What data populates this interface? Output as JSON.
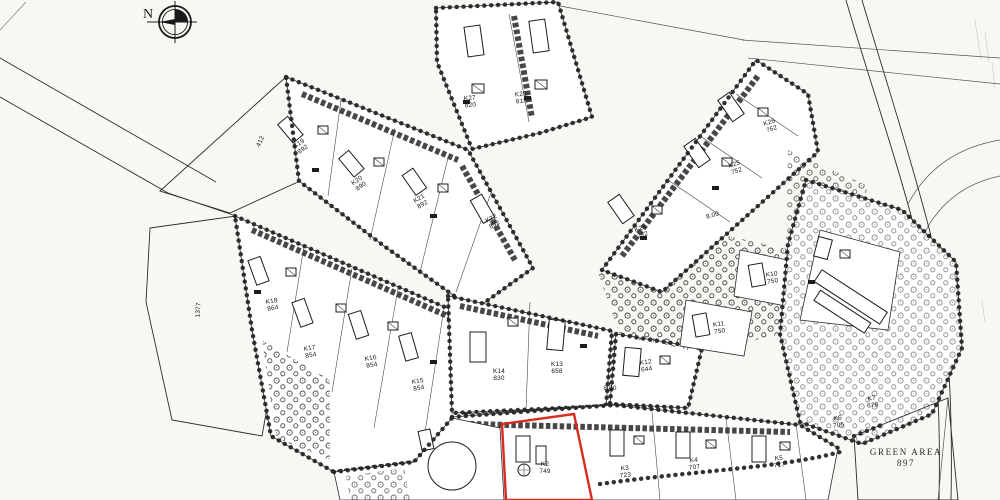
{
  "map": {
    "compass_label": "N",
    "green_area": {
      "name": "GREEN AREA",
      "number": "897"
    },
    "open_parcels": [
      {
        "number": "412"
      },
      {
        "number": "1377"
      }
    ],
    "dimensions": [
      "8.00",
      "8.00"
    ],
    "plots": [
      {
        "code": "K27",
        "area": "820"
      },
      {
        "code": "K28",
        "area": "818"
      },
      {
        "code": "K19",
        "area": "892"
      },
      {
        "code": "K20",
        "area": "890"
      },
      {
        "code": "K21",
        "area": "892"
      },
      {
        "code": "K22",
        "area": "832"
      },
      {
        "code": "K24",
        "area": "732"
      },
      {
        "code": "K25",
        "area": "752"
      },
      {
        "code": "K26",
        "area": "762"
      },
      {
        "code": "K18",
        "area": "864"
      },
      {
        "code": "K17",
        "area": "854"
      },
      {
        "code": "K16",
        "area": "854"
      },
      {
        "code": "K15",
        "area": "854"
      },
      {
        "code": "K14",
        "area": "830"
      },
      {
        "code": "K13",
        "area": "658"
      },
      {
        "code": "K12",
        "area": "644"
      },
      {
        "code": "K11",
        "area": "750"
      },
      {
        "code": "K10",
        "area": "750"
      },
      {
        "code": "K2",
        "area": "749",
        "highlighted": true
      },
      {
        "code": "K3",
        "area": "723"
      },
      {
        "code": "K4",
        "area": "707"
      },
      {
        "code": "K5",
        "area": "717"
      },
      {
        "code": "K6",
        "area": "705"
      },
      {
        "code": "K7",
        "area": "678"
      }
    ]
  },
  "colors": {
    "ink": "#1f1f1f",
    "paper": "#f7f7f3",
    "highlight": "#d92b1f"
  }
}
